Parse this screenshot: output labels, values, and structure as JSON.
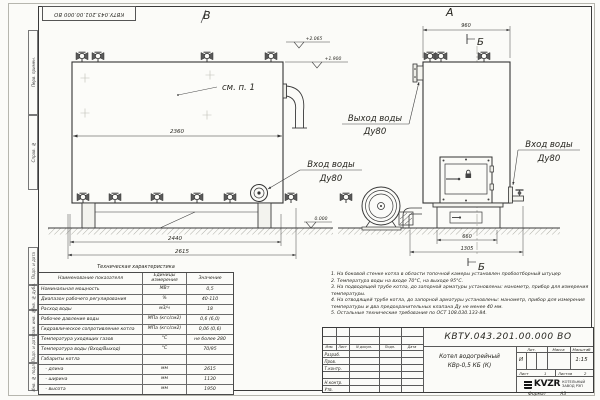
{
  "stamp_top": "КВТУ.043.201.00.000 ВО",
  "sidebar": {
    "labels": [
      "Перв. примен.",
      "Справ. №",
      "Подп. и дата",
      "Инв. № дубл.",
      "Взам. инв. №",
      "Подп. и дата",
      "Инв. № подл."
    ]
  },
  "drawing": {
    "view_b": "В",
    "view_a": "А",
    "cut_a": "А",
    "cut_b_top": "Б",
    "cut_b_bottom": "Б",
    "see_note": "см. п. 1",
    "labels": {
      "outlet1": "Выход воды",
      "outlet2": "Ду80",
      "inlet_side1": "Вход воды",
      "inlet_side2": "Ду80",
      "inlet_front1": "Вход воды",
      "inlet_front2": "Ду80"
    },
    "elev_top": "+2.065",
    "elev_mid": "+1.900",
    "elev_zero": "0.000",
    "dim_2360": "2360",
    "dim_2440": "2440",
    "dim_2615": "2615",
    "dim_960": "960",
    "dim_660": "660",
    "dim_1305": "1305"
  },
  "tech_table": {
    "title": "Техническая характеристика",
    "headers": [
      "Наименование показателя",
      "Единицы измерения",
      "Значение"
    ],
    "rows": [
      [
        "Номинальная мощность",
        "МВт",
        "0,5"
      ],
      [
        "Диапазон рабочего регулирования",
        "%",
        "40-110"
      ],
      [
        "Расход воды",
        "м3/ч",
        "18"
      ],
      [
        "Рабочее давление воды",
        "МПа (кгс/см2)",
        "0,6 (6,0)"
      ],
      [
        "Гидравлическое сопротивление котла",
        "МПа (кгс/см2)",
        "0,06 (0,6)"
      ],
      [
        "Температура уходящих газов",
        "°С",
        "не более 280"
      ],
      [
        "Температура воды (Вход/Выход)",
        "°С",
        "70/95"
      ],
      [
        "Габариты котла",
        "",
        ""
      ],
      [
        "   - длина",
        "мм",
        "2615"
      ],
      [
        "   - ширина",
        "мм",
        "1130"
      ],
      [
        "   - высота",
        "мм",
        "1950"
      ]
    ]
  },
  "notes": [
    "1. На боковой стенке котла в области топочной камеры установлен пробоотборный штуцер",
    "2. Температура воды на входе 70°С, на выходе 95°С.",
    "3. На подводящей трубе котла, до запорной арматуры установлены: манометр, прибор для измерения температуры.",
    "4. На отводящей трубе котла, до запорной арматуры установлены: манометр, прибор для измерения температуры и два предохранительных клапана Ду не менее 40 мм.",
    "5. Остальные технические требования по ОСТ 108.030.133-84."
  ],
  "title_block": {
    "doc_number": "КВТУ.043.201.00.000 ВО",
    "name_line1": "Котел водогрейный",
    "name_line2": "КВр-0,5 КБ (К)",
    "cols": {
      "izm": "Изм.",
      "list": "Лист",
      "doc": "N докум.",
      "podp": "Подп.",
      "data": "Дата"
    },
    "sign_rows": [
      "Разраб.",
      "Пров.",
      "Т.контр.",
      "Н.контр.",
      "Утв."
    ],
    "lit_header": "Лит.",
    "lit_value": "И",
    "massa_header": "Масса",
    "scale_header": "Масштаб",
    "scale_value": "1:15",
    "sheet_label": "Лист",
    "sheet_value": "1",
    "sheets_label": "Листов",
    "sheets_value": "2",
    "logo_text": "KVZR",
    "logo_line1": "КОТЕЛЬНЫЙ",
    "logo_line2": "ЗАВОД РЭП"
  },
  "format": {
    "label": "Формат",
    "value": "А3"
  }
}
